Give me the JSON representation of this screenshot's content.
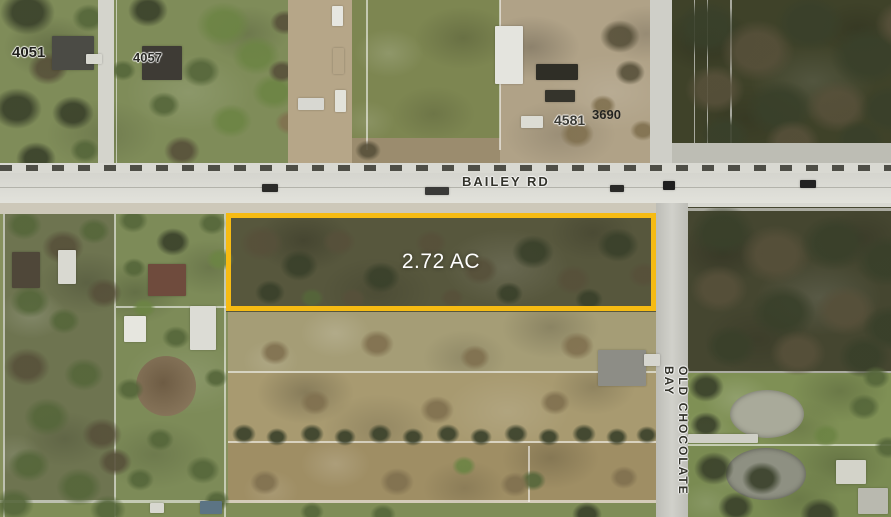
{
  "map": {
    "parcel": {
      "area_label": "2.72 AC",
      "outline_color": "#F6BB13",
      "area_label_text_color": "#FFFFFF"
    },
    "roads": {
      "bailey_rd": "BAILEY RD",
      "old_chocolate_bay": "OLD CHOCOLATE BAY"
    },
    "addresses": {
      "a4051": "4051",
      "a4057": "4057",
      "a4581": "4581",
      "a3690": "3690"
    },
    "colors": {
      "road_label_text": "#33332B",
      "road_surface": "#E0E0D9",
      "woods_dark": "#454630",
      "field_tan": "#A89A70",
      "lawn_green": "#7F9055",
      "pond_gray": "#A9AA9A"
    }
  }
}
